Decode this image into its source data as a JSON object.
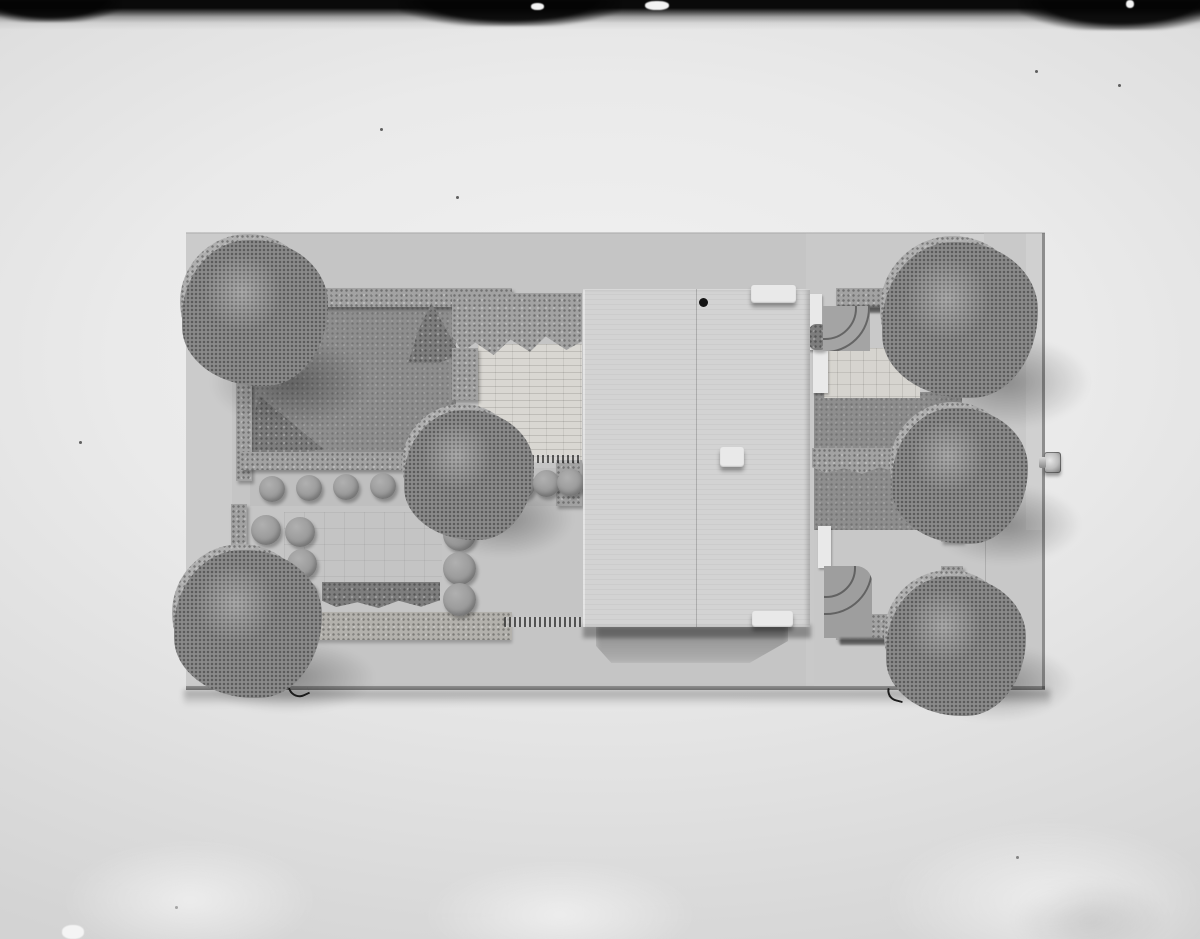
{
  "scene": {
    "medium": "black-and-white photograph",
    "subject": "Top view of an architectural scale model: a flat-roofed rectangular building in the centre with formal gardens on both sides — six large round sponge trees, rows of ball-shaped bushes, clipped hedge strips, dark lawn panels, brick and tile paved courts — mounted on a rectangular baseboard photographed on light paper",
    "tree_count": 6,
    "bush_ball_count": 15,
    "rooftop_block_count": 3
  },
  "colors": {
    "film_black": "#0a0a0a",
    "paper_light": "#f1f1f1",
    "paper_dark": "#d3d3d3",
    "board": "#c5c5c5",
    "board_light": "#d0d0d0",
    "building": "#d3d3d3",
    "white_detail": "#e9e9e9",
    "lawn": "#8e8e8e",
    "courtyard": "#c4c4c4",
    "hedge": "#a2a2a2",
    "hedge_dark": "#7d7d7d",
    "sponge_light": "#b3b1ac",
    "brick": "#d9d7d2",
    "tile": "#d6d4cf",
    "tree": "#a9a9a9",
    "tree_dark": "#8a8a8a",
    "ball": "#9a9a9a",
    "pin": "#bdbdbd",
    "shadow": "rgba(0,0,0,0.30)"
  }
}
